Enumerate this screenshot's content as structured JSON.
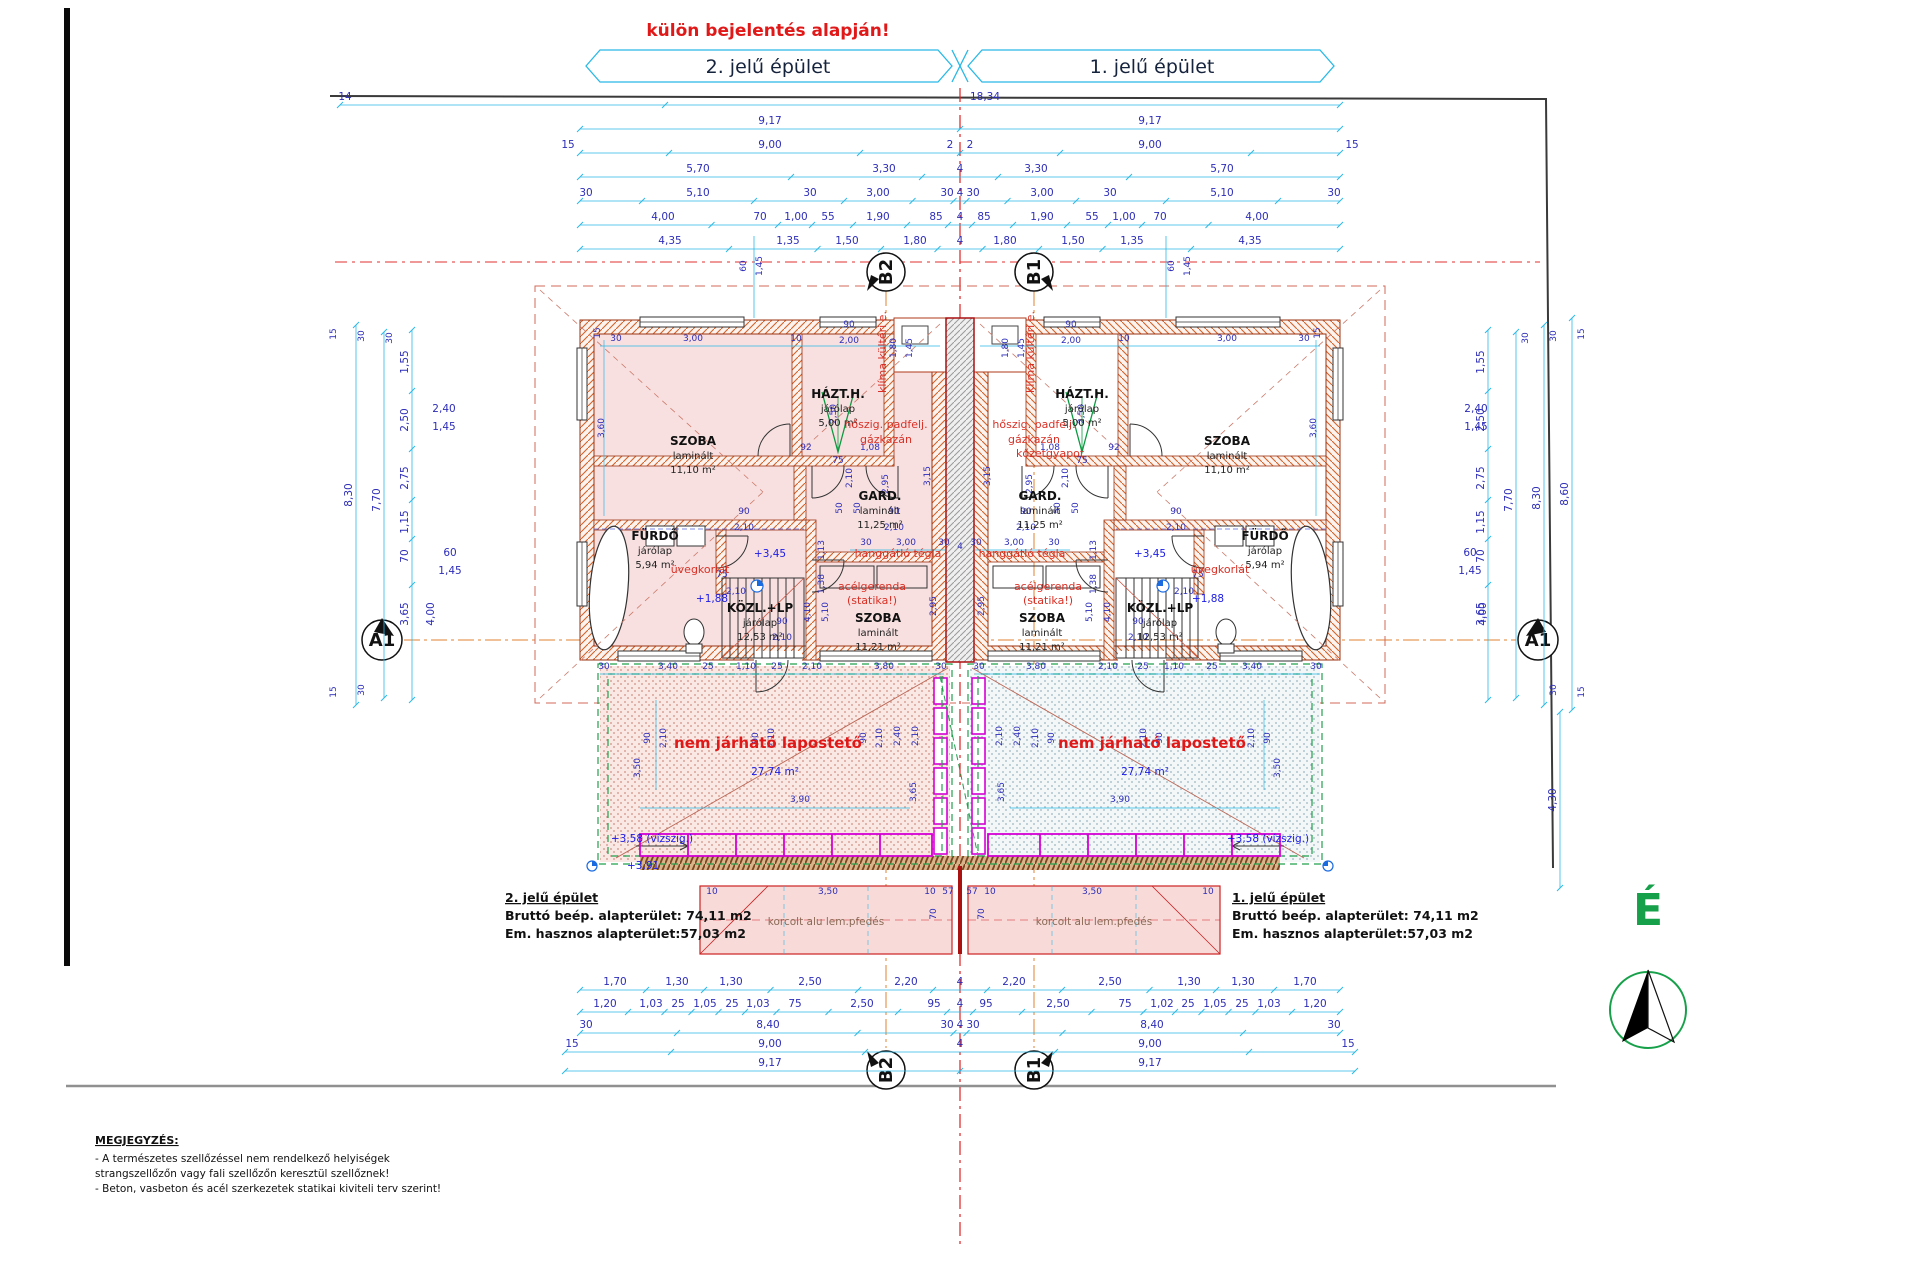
{
  "page": {
    "warning": "külön bejelentés alapján!"
  },
  "bands": {
    "building2": "2. jelű épület",
    "building1": "1. jelű épület"
  },
  "markers": {
    "b2": "B2",
    "b1": "B1",
    "a1": "A1"
  },
  "north_label": "É",
  "summary": {
    "b2": {
      "title": "2. jelű épület",
      "gross": "Bruttó beép. alapterület: 74,11 m2",
      "net": "Em. hasznos alapterület:57,03 m2"
    },
    "b1": {
      "title": "1. jelű épület",
      "gross": "Bruttó beép. alapterület: 74,11 m2",
      "net": "Em. hasznos alapterület:57,03 m2"
    }
  },
  "notes": {
    "heading": "MEGJEGYZÉS:",
    "lines": [
      "- A természetes szellőzéssel nem rendelkező helyiségek",
      "strangszellőzőn vagy fali szellőzőn keresztül szellőznek!",
      "- Beton, vasbeton és acél szerkezetek statikai kiviteli terv szerint!"
    ]
  },
  "dims": {
    "top_rows": [
      [
        "14",
        "18,34"
      ],
      [
        "9,17",
        "9,17"
      ],
      [
        "15",
        "9,00",
        "2",
        "2",
        "9,00",
        "15"
      ],
      [
        "5,70",
        "3,30",
        "4",
        "3,30",
        "5,70"
      ],
      [
        "30",
        "5,10",
        "30",
        "3,00",
        "30",
        "4",
        "30",
        "3,00",
        "30",
        "5,10",
        "30"
      ],
      [
        "4,00",
        "70",
        "1,00",
        "55",
        "1,90",
        "85",
        "4",
        "85",
        "1,90",
        "55",
        "1,00",
        "70",
        "4,00"
      ],
      [
        "4,35",
        "1,35",
        "1,50",
        "1,80",
        "4",
        "1,80",
        "1,50",
        "1,35",
        "4,35"
      ]
    ],
    "bottom_rows": [
      [
        "1,70",
        "1,30",
        "1,30",
        "2,50",
        "2,20",
        "4",
        "2,20",
        "2,50",
        "1,30",
        "1,30",
        "1,70"
      ],
      [
        "1,20",
        "1,03",
        "25",
        "1,05",
        "25",
        "1,03",
        "75",
        "2,50",
        "95",
        "4",
        "95",
        "2,50",
        "75",
        "1,02",
        "25",
        "1,05",
        "25",
        "1,03",
        "1,20"
      ],
      [
        "30",
        "8,40",
        "30",
        "4",
        "30",
        "8,40",
        "30"
      ],
      [
        "15",
        "9,00",
        "4",
        "9,00",
        "15"
      ],
      [
        "9,17",
        "9,17"
      ]
    ],
    "side_sub": [
      "1,55",
      "2,50",
      "2,75",
      "1,15",
      "70",
      "3,65"
    ],
    "left_totals": [
      "8,30",
      "7,70"
    ],
    "right_totals": [
      "8,60",
      "8,30",
      "7,70"
    ],
    "right_terrace": "4,30",
    "four_meters": "4,00",
    "stack_a": [
      "2,40",
      "1,45"
    ],
    "stack_b": [
      "60",
      "1,45"
    ],
    "edge_small": [
      "15",
      "30",
      "30"
    ],
    "above_pair_a": [
      "60",
      "1,45"
    ],
    "above_pair_b": [
      "1,80",
      "1,45"
    ],
    "center_gap": "4"
  },
  "unit": {
    "rooms": [
      {
        "name": "SZOBA",
        "finish": "laminált",
        "area": "11,10 m²"
      },
      {
        "name": "HÁZT.H.",
        "finish": "járólap",
        "area": "5,00 m²"
      },
      {
        "name": "GARD.",
        "finish": "laminált",
        "area": "11,25 m²"
      },
      {
        "name": "FÜRDŐ",
        "finish": "járólap",
        "area": "5,94 m²"
      },
      {
        "name": "KÖZL.+LP",
        "finish": "járólap",
        "area": "12,53 m²"
      },
      {
        "name": "SZOBA",
        "finish": "laminált",
        "area": "11,21 m²"
      }
    ],
    "annotations": {
      "boiler1": "hőszig. padfelj.",
      "boiler2": "gázkazán",
      "sound": "hanggátló tégla",
      "beam1": "acélgerenda",
      "beam2": "(statika!)",
      "glass": "üvegkorlát",
      "hvac": "klíma kültéri e.",
      "roof": "nem járható lapostető",
      "roof_metal": "korcolt alu lem.pfedés"
    },
    "levels": {
      "p345": "+3,45",
      "p188": "+1,88",
      "p358": "+3,58 (vízszig.)",
      "p391": "+3,91"
    },
    "terrace_area": "27,74 m²",
    "insulation": "kőzetgyapot",
    "dims": [
      "3,00",
      "30",
      "10",
      "90",
      "2,00",
      "15",
      "3,60",
      "2,50",
      "92",
      "1,08",
      "75",
      "2,10",
      "50",
      "50",
      "90",
      "2,10",
      "90",
      "2,10",
      "2,95",
      "3,15",
      "30",
      "3,00",
      "30",
      "75",
      "2,10",
      "1,13",
      "1,38",
      "4,10",
      "5,10",
      "90",
      "2,10",
      "3,40",
      "25",
      "1,10",
      "25",
      "2,10",
      "3,80",
      "30",
      "30",
      "90",
      "2,10",
      "90",
      "2,10",
      "90",
      "2,10",
      "3,50",
      "3,65",
      "2,40",
      "2,10",
      "3,90",
      "10",
      "3,50",
      "10",
      "57",
      "70",
      "2,95"
    ]
  }
}
